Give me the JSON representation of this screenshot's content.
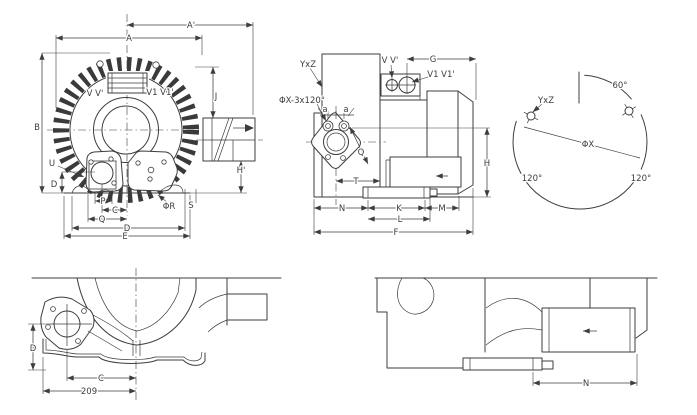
{
  "colors": {
    "line": "#3d3d3d",
    "background": "#ffffff"
  },
  "front_view": {
    "A_prime": "A'",
    "A": "A",
    "B": "B",
    "J": "J",
    "H_prime": "H'",
    "U": "U",
    "D_left": "D",
    "V_ports": "V V'",
    "V1_ports": "V1 V1'",
    "P": "P",
    "C": "C",
    "Q": "Q",
    "D": "D",
    "E": "E",
    "phi_R": "ΦR",
    "S": "S"
  },
  "side_view": {
    "YxZ": "YxZ",
    "phiX_pattern": "ΦX-3x120°",
    "V_ports": "V V'",
    "V1_ports": "V1 V1'",
    "G": "G",
    "a_left": "a",
    "a_right": "a",
    "Q": "Q",
    "T": "T",
    "N": "N",
    "K": "K",
    "M": "M",
    "L": "L",
    "F": "F",
    "H": "H"
  },
  "bolt_circle": {
    "angle_60": "60°",
    "YxZ": "YxZ",
    "phi_X": "ΦX",
    "angle_120_left": "120°",
    "angle_120_right": "120°"
  },
  "bottom_left_view": {
    "D": "D",
    "C": "C",
    "width_209": "209"
  },
  "bottom_right_view": {
    "N": "N"
  }
}
